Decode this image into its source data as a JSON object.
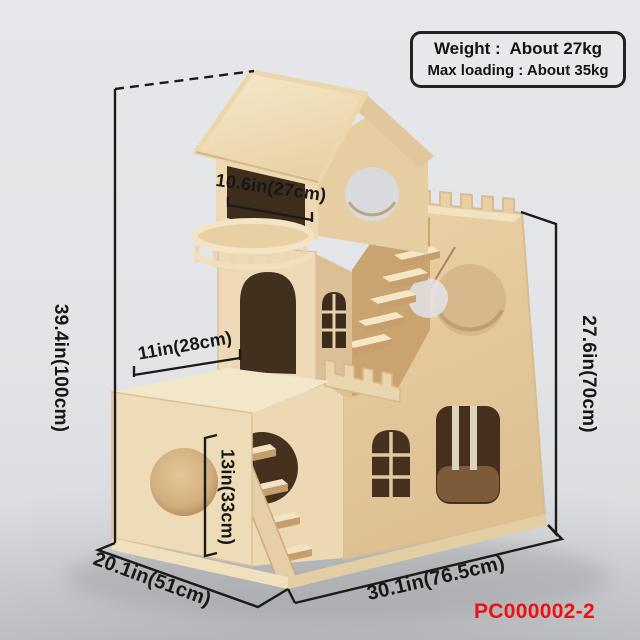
{
  "info_box": {
    "line1": "Weight :  About 27kg",
    "line2": "Max loading : About 35kg"
  },
  "dimensions": {
    "height_total": "39.4in(100cm)",
    "height_right": "27.6in(70cm)",
    "top_width": "10.6in(27cm)",
    "box_width": "11in(28cm)",
    "box_height": "13in(33cm)",
    "depth": "20.1in(51cm)",
    "width": "30.1in(76.5cm)"
  },
  "product_code": "PC000002-2",
  "colors": {
    "accent_red": "#ed1111",
    "annotation_black": "#1b1b1b",
    "wood_light": "#f2e5c6",
    "wood_front": "#eedab5",
    "wood_shadow": "#e2c79c",
    "opening_dark": "#3f2c1c",
    "background": "#e3e4e7"
  }
}
